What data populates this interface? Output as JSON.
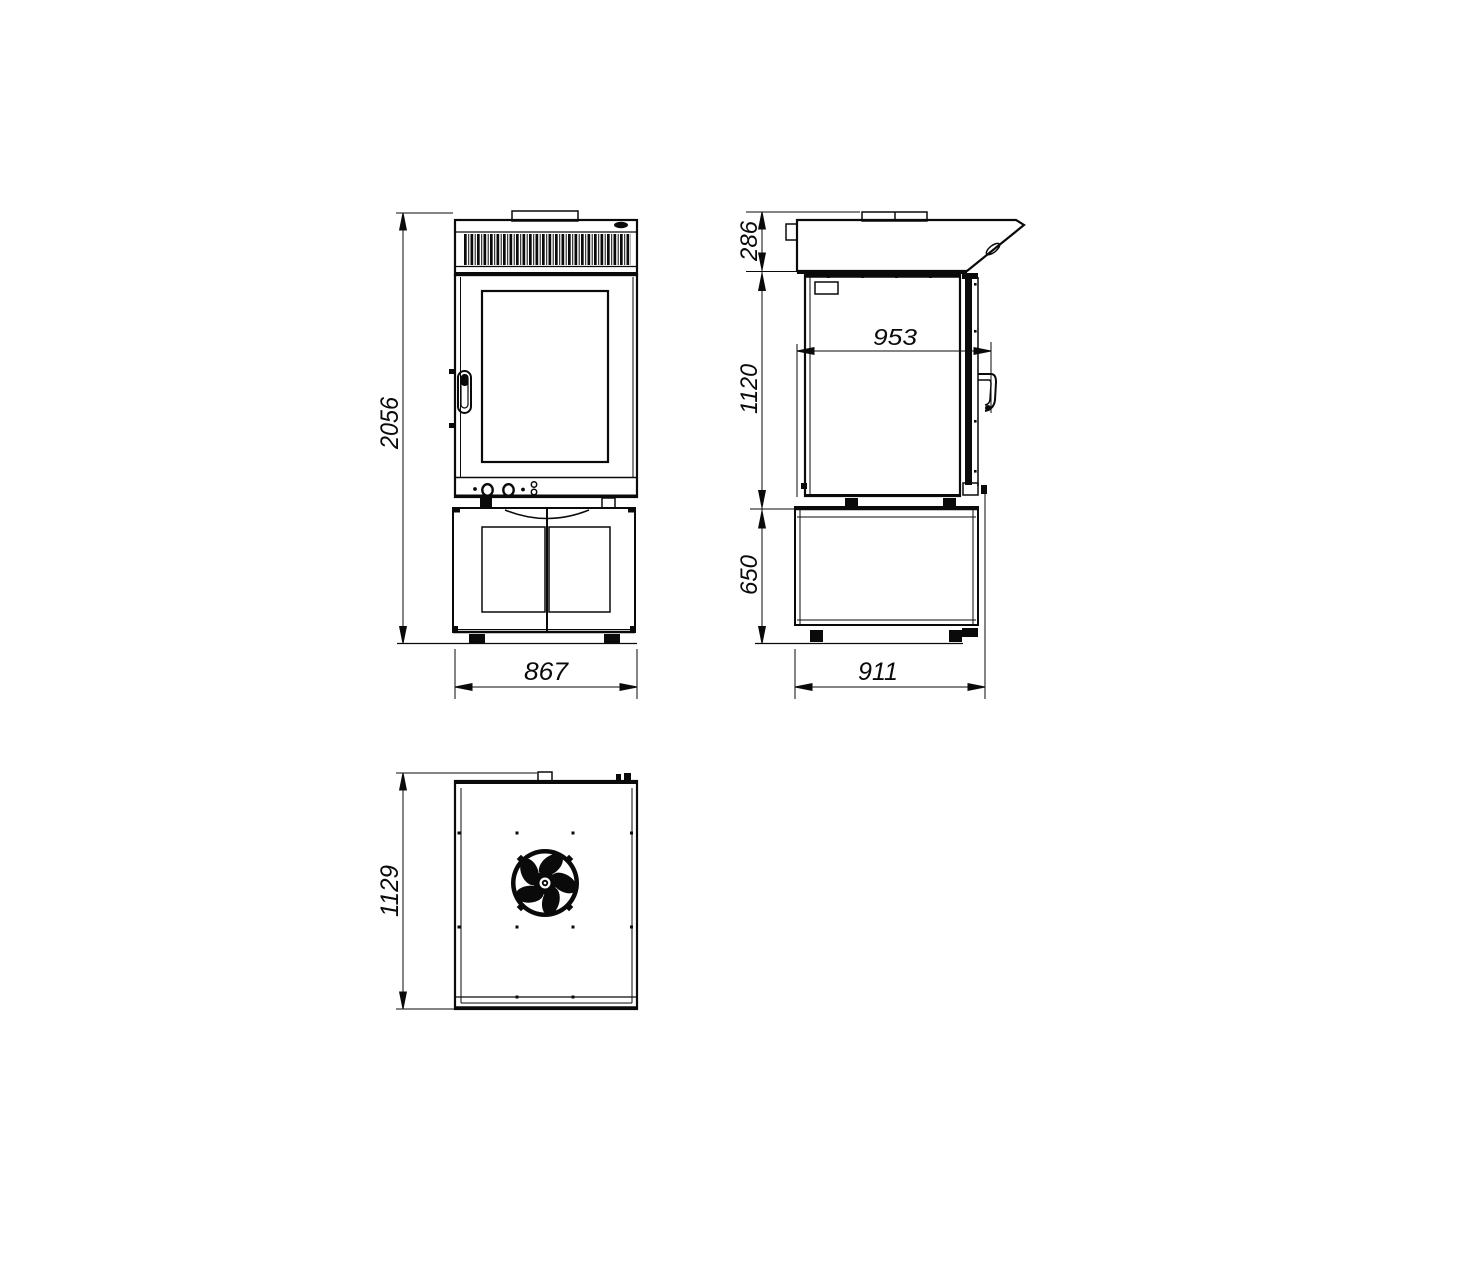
{
  "colors": {
    "line": "#0a0a0a",
    "background": "#ffffff"
  },
  "icons": {
    "fan": "fan-icon"
  },
  "views": {
    "front": {
      "dims": {
        "overall_height": "2056",
        "overall_width": "867"
      }
    },
    "side": {
      "dims": {
        "hood_height": "286",
        "body_height": "1120",
        "stand_height": "650",
        "inner_depth": "953",
        "stand_depth": "911"
      }
    },
    "top": {
      "dims": {
        "overall_depth": "1129"
      }
    }
  }
}
